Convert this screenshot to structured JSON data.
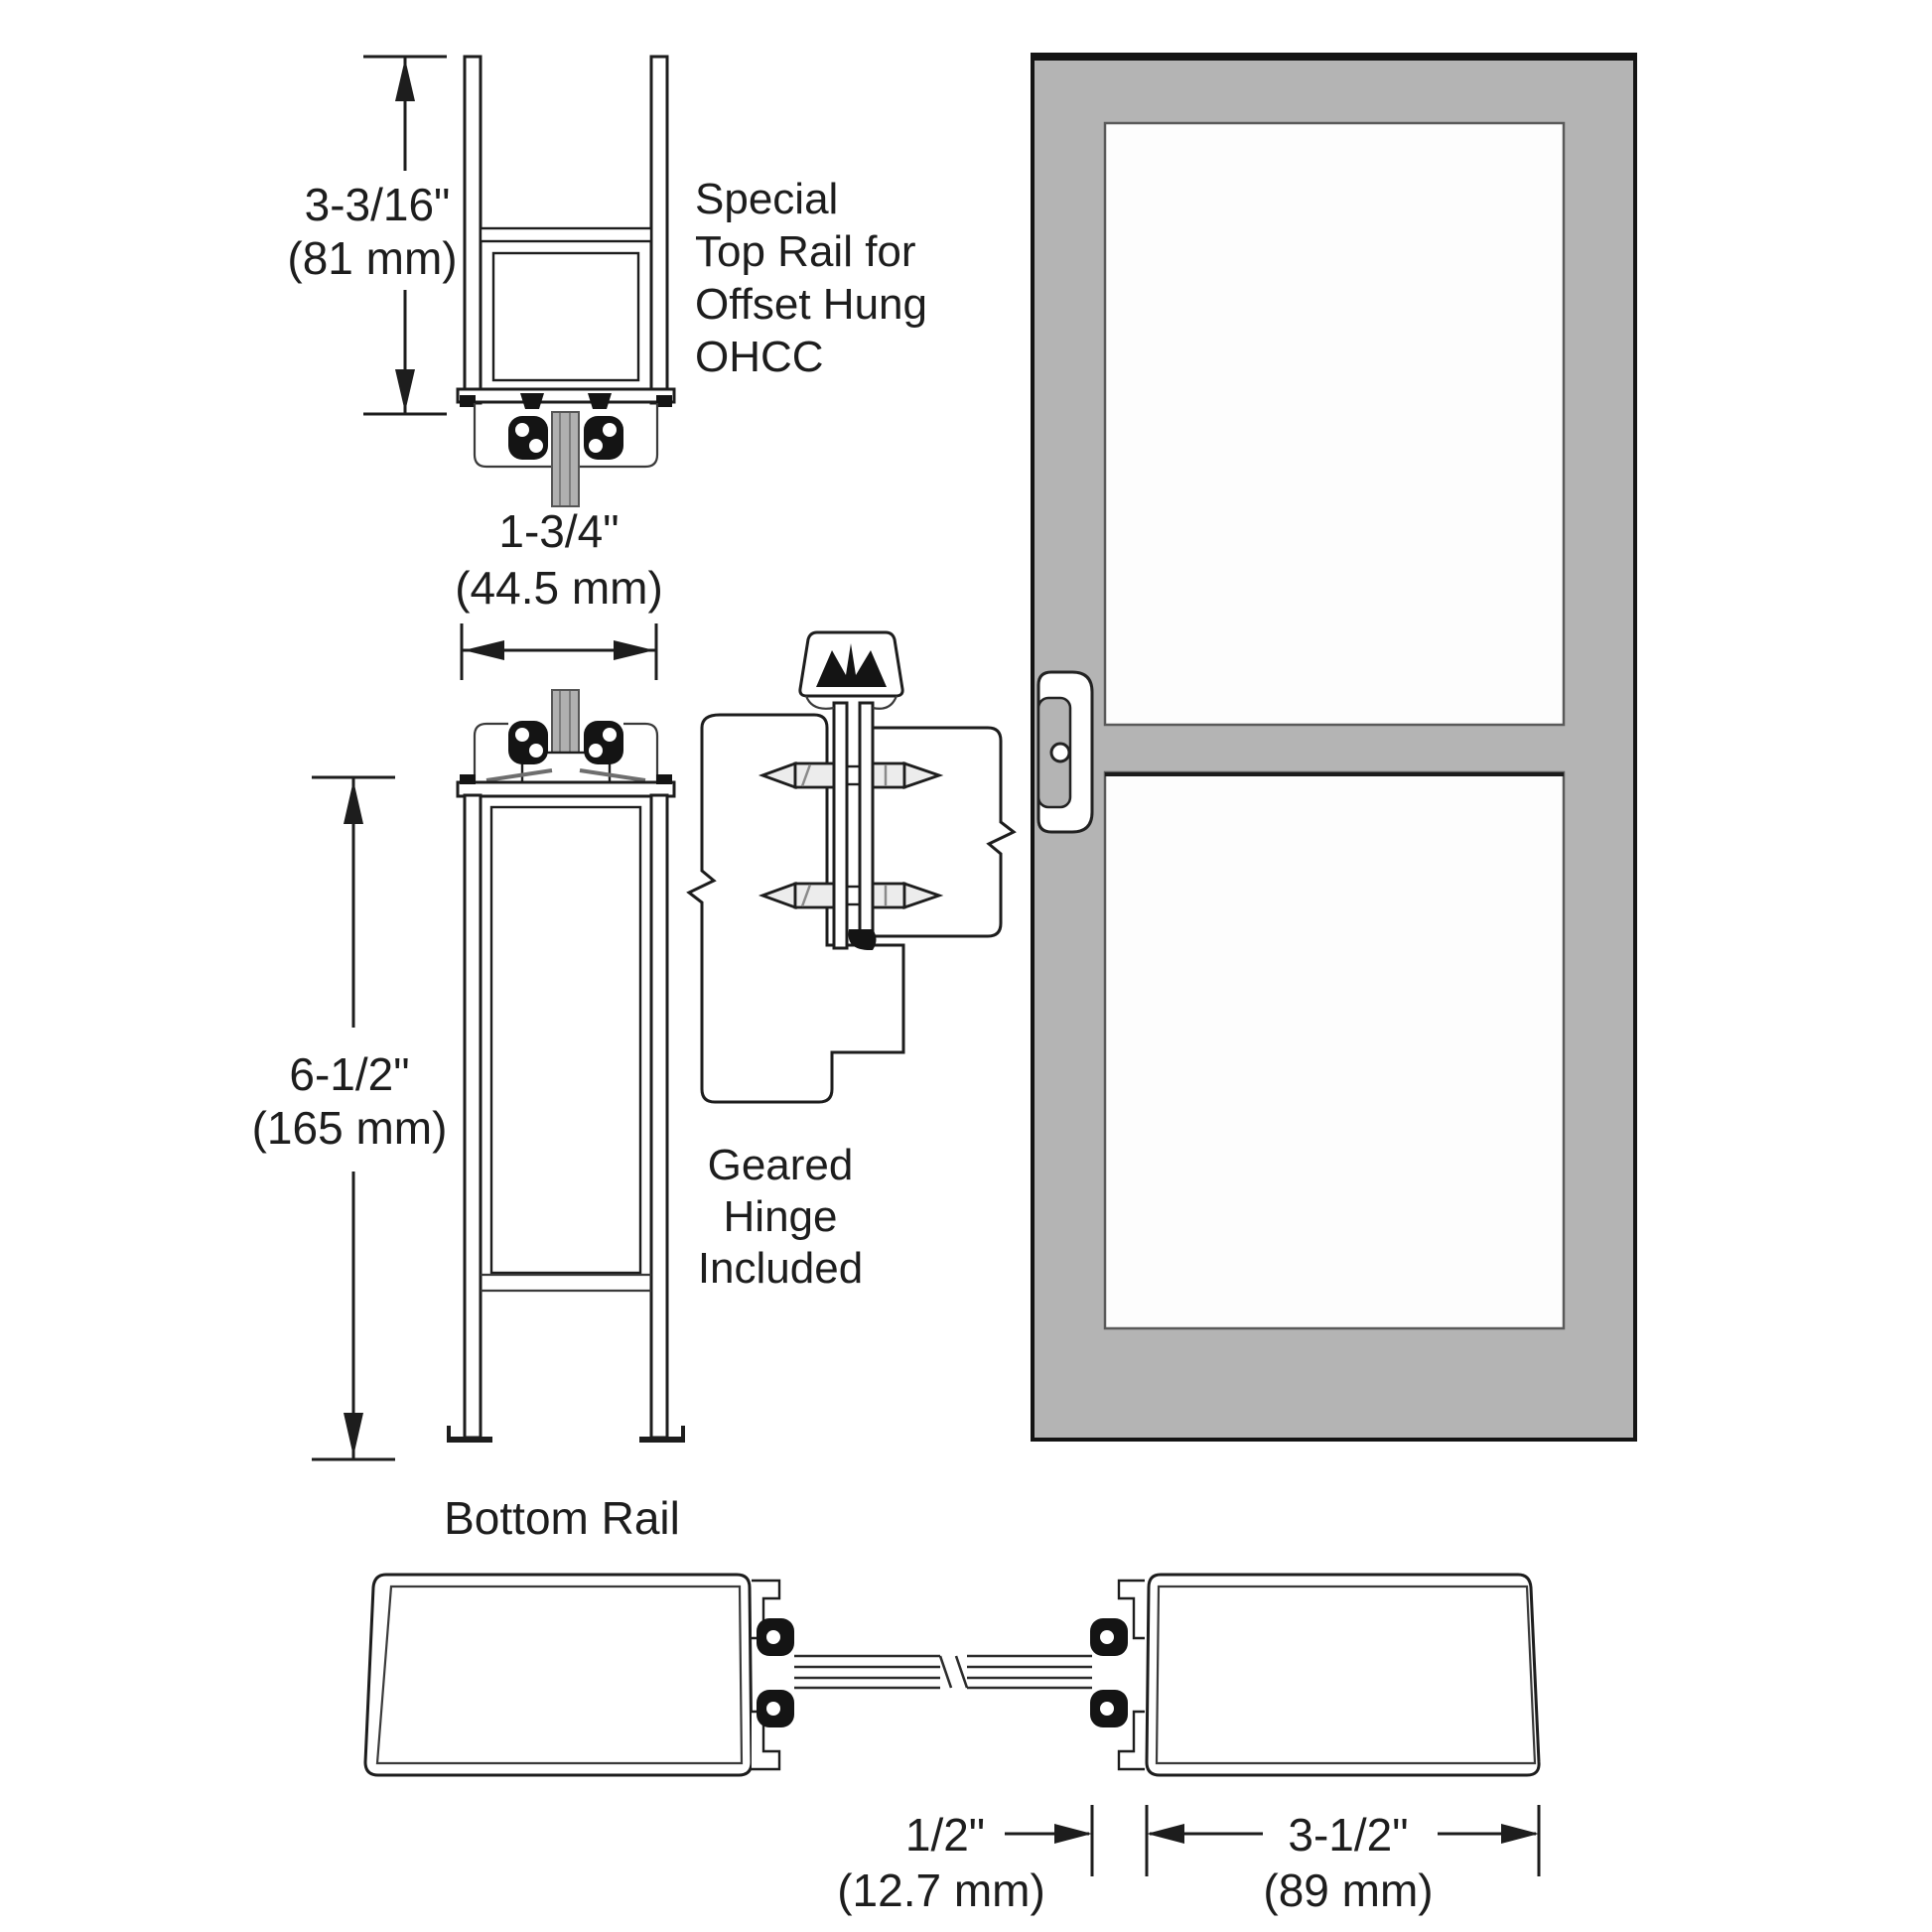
{
  "colors": {
    "line": "#1d1d1d",
    "door_gray": "#b4b4b4",
    "glass_white": "#fdfdfd",
    "glass_section_gray": "#b0b0b0",
    "background": "#ffffff"
  },
  "top_rail": {
    "height_in": "3-3/16\"",
    "height_mm": "(81 mm)",
    "width_in": "1-3/4\"",
    "width_mm": "(44.5 mm)",
    "note_lines": [
      "Special",
      "Top Rail for",
      "Offset Hung",
      "OHCC"
    ]
  },
  "bottom_rail": {
    "height_in": "6-1/2\"",
    "height_mm": "(165 mm)",
    "label": "Bottom Rail"
  },
  "hinge": {
    "note_lines": [
      "Geared",
      "Hinge",
      "Included"
    ]
  },
  "stile_section": {
    "glass_pocket_in": "1/2\"",
    "glass_pocket_mm": "(12.7 mm)",
    "stile_width_in": "3-1/2\"",
    "stile_width_mm": "(89 mm)"
  }
}
